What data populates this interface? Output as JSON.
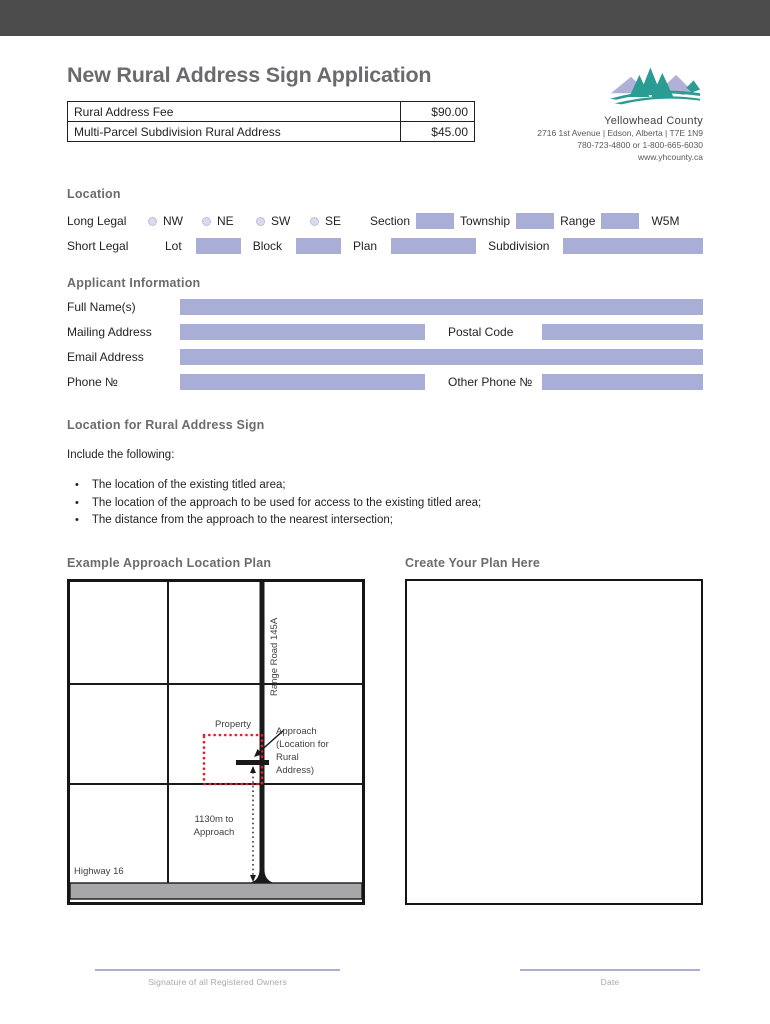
{
  "page": {
    "title": "New Rural Address Sign Application"
  },
  "header": {
    "org": "Yellowhead County",
    "address": "2716 1st Avenue | Edson, Alberta | T7E 1N9",
    "phone": "780-723-4800 or 1-800-665-6030",
    "website": "www.yhcounty.ca"
  },
  "fees": {
    "rows": [
      {
        "label": "Rural Address Fee",
        "amount": "$90.00"
      },
      {
        "label": "Multi-Parcel Subdivision Rural Address",
        "amount": "$45.00"
      }
    ]
  },
  "location": {
    "heading": "Location",
    "long_legal_label": "Long Legal",
    "quarters": [
      "NW",
      "NE",
      "SW",
      "SE"
    ],
    "section_label": "Section",
    "township_label": "Township",
    "range_label": "Range",
    "meridian": "W5M",
    "short_legal_label": "Short Legal",
    "lot_label": "Lot",
    "block_label": "Block",
    "plan_label": "Plan",
    "subdivision_label": "Subdivision"
  },
  "applicant": {
    "heading": "Applicant Information",
    "full_name_label": "Full Name(s)",
    "mailing_label": "Mailing Address",
    "postal_label": "Postal Code",
    "email_label": "Email Address",
    "phone_label": "Phone №",
    "other_phone_label": "Other Phone №"
  },
  "sign_location": {
    "heading": "Location for Rural Address Sign",
    "intro": "Include the following:",
    "bullets": [
      "The location of the existing titled area;",
      "The location of the approach to be used for access to the existing titled area;",
      "The distance from the approach to the nearest intersection;"
    ]
  },
  "plans": {
    "example_heading": "Example Approach Location Plan",
    "create_heading": "Create Your Plan Here",
    "example": {
      "road_label": "Range Road 145A",
      "property_label": "Property",
      "approach_label": "Approach (Location for Rural Address)",
      "distance_label": "1130m to Approach",
      "highway_label": "Highway 16"
    }
  },
  "footer": {
    "signature_label": "Signature of all Registered Owners",
    "date_label": "Date"
  },
  "colors": {
    "top_bar": "#4c4c4c",
    "field": "#a8aed6",
    "heading_gray": "#6b6c6f",
    "logo_teal": "#2b9c94",
    "logo_purple": "#b1b1d8",
    "property_red": "#ec1c24",
    "highway_gray": "#a7a7a9",
    "signature_line": "#a9aed6"
  }
}
